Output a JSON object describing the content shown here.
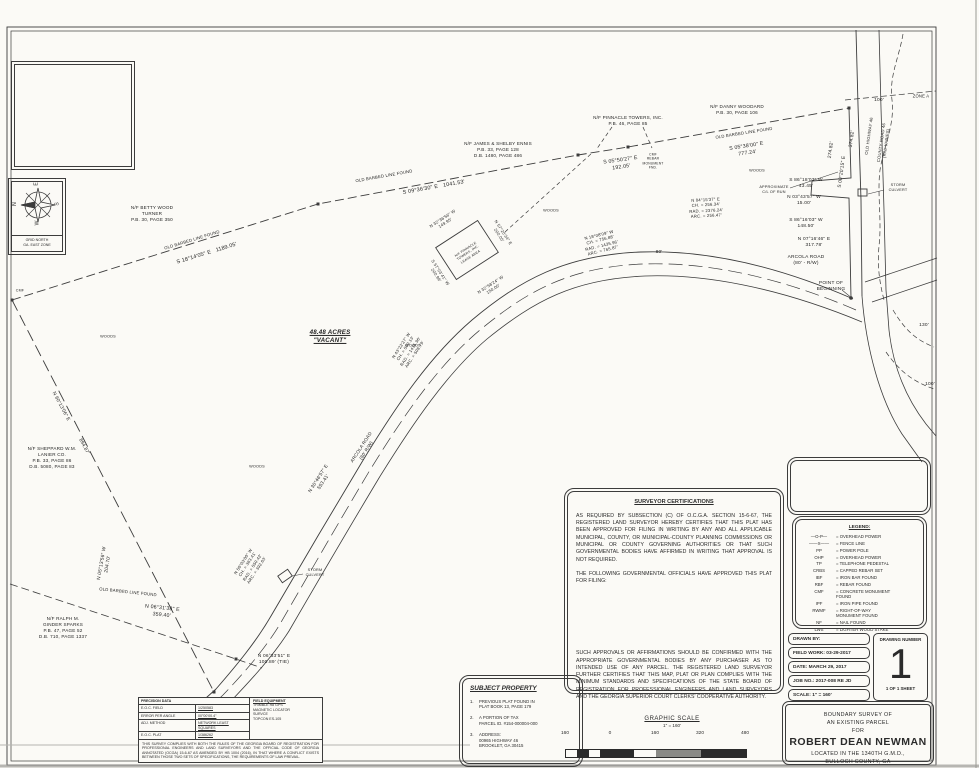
{
  "compass": {
    "n": "N",
    "e": "E",
    "s": "S",
    "w": "W",
    "caption": "GRID NORTH\nGA. EAST ZONE"
  },
  "parcel": {
    "acreage_label": "48.48 ACRES\n\"VACANT\""
  },
  "certs": {
    "title": "SURVEYOR CERTIFICATIONS",
    "p1": "AS REQUIRED BY SUBSECTION (C) OF O.C.G.A. SECTION 15-6-67, THE REGISTERED LAND SURVEYOR HEREBY CERTIFIES THAT THIS PLAT HAS BEEN APPROVED FOR FILING IN WRITING BY ANY AND ALL APPLICABLE MUNICIPAL, COUNTY, OR MUNICIPAL-COUNTY PLANNING COMMISSIONS OR MUNICIPAL OR COUNTY GOVERNING AUTHORITIES OR THAT SUCH GOVERNMENTAL BODIES HAVE AFFIRMED IN WRITING THAT APPROVAL IS NOT REQUIRED.",
    "p2": "THE FOLLOWING GOVERNMENTAL OFFICIALS HAVE APPROVED THIS PLAT FOR FILING:",
    "p3": "SUCH APPROVALS OR AFFIRMATIONS SHOULD BE CONFIRMED WITH THE APPROPRIATE GOVERNMENTAL BODIES BY ANY PURCHASER AS TO INTENDED USE OF ANY PARCEL. THE REGISTERED LAND SURVEYOR FURTHER CERTIFIES THAT THIS MAP, PLAT OR PLAN COMPLIES WITH THE MINIMUM STANDARDS AND SPECIFICATIONS OF THE STATE BOARD OF REGISTRATION FOR PROFESSIONAL ENGINEERS AND LAND SURVEYORS AND THE GEORGIA SUPERIOR COURT CLERKS' COOPERATIVE AUTHORITY."
  },
  "legend": {
    "title": "LEGEND:",
    "rows": [
      {
        "s": "—O-P—",
        "l": "= OVERHEAD POWER"
      },
      {
        "s": "——X——",
        "l": "= FENCE LINE"
      },
      {
        "s": "PP",
        "l": "= POWER POLE"
      },
      {
        "s": "OHP",
        "l": "= OVERHEAD POWER"
      },
      {
        "s": "TP",
        "l": "= TELEPHONE PEDESTAL"
      },
      {
        "s": "CRBS",
        "l": "= CAPPED REBAR SET"
      },
      {
        "s": "IBF",
        "l": "= IRON BAR FOUND"
      },
      {
        "s": "RBF",
        "l": "= REBAR FOUND"
      },
      {
        "s": "CMF",
        "l": "= CONCRETE MONUMENT\nFOUND"
      },
      {
        "s": "IPF",
        "l": "= IRON PIPE FOUND"
      },
      {
        "s": "RWMF",
        "l": "= RIGHT-OF-WAY\nMONUMENT FOUND"
      },
      {
        "s": "NF",
        "l": "= NAIL FOUND"
      },
      {
        "s": "LWS",
        "l": "= LIGHTER WOOD STAKE"
      }
    ]
  },
  "title_block": {
    "drawn_by": "DRAWN BY:",
    "field_work": "FIELD WORK: 03-29-2017",
    "date": "DATE: MARCH 29, 2017",
    "job_no": "JOB NO.: 2017-008 RE JD",
    "scale": "SCALE: 1\" = 160'",
    "drawing_number_label": "DRAWING NUMBER",
    "drawing_number": "1",
    "sheet": "1 OF 1 SHEET",
    "survey_title_lines": [
      "BOUNDARY SURVEY OF",
      "AN EXISTING PARCEL",
      "FOR",
      "ROBERT DEAN NEWMAN",
      "LOCATED IN THE 1340TH G.M.D.,",
      "BULLOCH COUNTY, GA"
    ]
  },
  "subject": {
    "title": "SUBJECT PROPERTY",
    "items": [
      {
        "n": "1.",
        "t": "PREVIOUS PLAT FOUND IN\nPLAT BOOK 13, PAGE 179"
      },
      {
        "n": "2.",
        "t": "A PORTION OF TAX\nPARCEL ID. #154-000004-000"
      },
      {
        "n": "3.",
        "t": "ADDRESS:\n00965 HIGHWAY 46\nBROOKLET, GA 30415"
      }
    ]
  },
  "precision": {
    "title": "PRECISION DATA",
    "rows": [
      {
        "k": "E.O.C. FIELD",
        "v": "1/250583"
      },
      {
        "k": "ERROR PER ANGLE",
        "v": "00°00'00.4\""
      },
      {
        "k": "ADJ. METHOD",
        "v": "NETWORK LEAST SQUARES"
      },
      {
        "k": "E.O.C. PLAT",
        "v": "1/386262"
      }
    ],
    "equip_title": "FIELD EQUIPMENT",
    "equip": [
      "TRIMBLE R8 GPS",
      "MAGNETIC LOCATOR",
      "SURVCE",
      "TOPCON ES-105"
    ],
    "note": "THIS SURVEY COMPLIES WITH BOTH THE RULES OF THE GEORGIA BOARD OF REGISTRATION FOR PROFESSIONAL ENGINEERS AND LAND SURVEYORS AND THE OFFICIAL CODE OF GEORGIA ANNOTATED (OCGA) 15-6-67 AS AMENDED BY HB 1004 (2016), IN THAT WHERE A CONFLICT EXISTS BETWEEN THOSE TWO SETS OF SPECIFICATIONS, THE REQUIREMENTS OF LAW PREVAIL."
  },
  "scale_bar": {
    "title": "GRAPHIC SCALE",
    "sub": "1\" = 160'",
    "ticks": [
      "160",
      "0",
      "160",
      "320",
      "480"
    ]
  },
  "map_labels": [
    {
      "t": "N/F BETTY WOOD\nTURNER\nP.B. 30, PAGE 350",
      "x": 152,
      "y": 214,
      "s": 4.6
    },
    {
      "t": "N/F JAMES & SHELBY ENNIS\nP.B. 33, PAGE 128\nD.B. 1480, PAGE 486",
      "x": 498,
      "y": 150,
      "s": 4.6
    },
    {
      "t": "N/F PINNACLE TOWERS, INC.\nP.B. 46, PAGE 85",
      "x": 628,
      "y": 121,
      "s": 4.6
    },
    {
      "t": "N/F DANNY WOODARD\nP.B. 30, PAGE 106",
      "x": 737,
      "y": 110,
      "s": 4.6
    },
    {
      "t": "N/F SHEPPARD W.M.\nLANIER CO.\nP.B. 33, PAGE 86\nD.B. 5080, PAGE 83",
      "x": 52,
      "y": 458,
      "s": 4.6
    },
    {
      "t": "N/F RALPH M.\nGINDER SPARKS\nP.B. 47, PAGE 52\nD.B. 710, PAGE 1337",
      "x": 63,
      "y": 628,
      "s": 4.6
    },
    {
      "t": "OLD BARBED LINE FOUND",
      "x": 192,
      "y": 240,
      "r": -17,
      "s": 4.2
    },
    {
      "t": "S 18°14'05\" E   1189.05'",
      "x": 207,
      "y": 254,
      "r": -17,
      "s": 5.4
    },
    {
      "t": "OLD BARBED LINE FOUND",
      "x": 384,
      "y": 176,
      "r": -10,
      "s": 4.2
    },
    {
      "t": "S 09°36'30\" E   1041.53'",
      "x": 434,
      "y": 188,
      "r": -10,
      "s": 5.4
    },
    {
      "t": "S 05°50'27\" E\n192.05'",
      "x": 621,
      "y": 164,
      "r": -8,
      "s": 5.2
    },
    {
      "t": "OLD BARBED LINE FOUND",
      "x": 744,
      "y": 133,
      "r": -9,
      "s": 4.2
    },
    {
      "t": "S 05°38'00\" E\n777.24'",
      "x": 747,
      "y": 150,
      "r": -9,
      "s": 5.2
    },
    {
      "t": "CMF\nREBAR\nMONUMENT\nFND.",
      "x": 653,
      "y": 161,
      "s": 3.3
    },
    {
      "t": "ZONE A",
      "x": 921,
      "y": 96,
      "s": 4.2
    },
    {
      "t": "100'",
      "x": 879,
      "y": 101,
      "s": 4.8
    },
    {
      "t": "S 00°20'15\" E",
      "x": 843,
      "y": 172,
      "r": -82,
      "s": 4.8
    },
    {
      "t": "374.82'",
      "x": 853,
      "y": 139,
      "r": -82,
      "s": 4.8
    },
    {
      "t": "274.82'",
      "x": 832,
      "y": 150,
      "r": -82,
      "s": 4.8
    },
    {
      "t": "OLD HIGHWAY 46",
      "x": 869,
      "y": 136,
      "r": -82,
      "s": 4.2
    },
    {
      "t": "COUNTY ROAD 46\n(R/W VARIES)",
      "x": 884,
      "y": 143,
      "r": -82,
      "s": 4.2
    },
    {
      "t": "STORM\nCULVERT",
      "x": 898,
      "y": 188,
      "s": 3.8
    },
    {
      "t": "APPROXIMATE\nC/L OF RUN",
      "x": 774,
      "y": 190,
      "s": 3.8
    },
    {
      "t": "S 86°18'03\" W\n43.45'",
      "x": 806,
      "y": 184,
      "s": 4.8
    },
    {
      "t": "N 03°43'57\" W\n15.00'",
      "x": 804,
      "y": 201,
      "s": 4.8
    },
    {
      "t": "S 86°16'03\" W\n148.50'",
      "x": 806,
      "y": 224,
      "s": 4.8
    },
    {
      "t": "N 07°16'46\" E\n317.78'",
      "x": 814,
      "y": 243,
      "s": 4.8
    },
    {
      "t": "ARCOLA ROAD\n(80' - R/W)",
      "x": 806,
      "y": 261,
      "s": 4.8
    },
    {
      "t": "POINT OF\nBEGINNING",
      "x": 831,
      "y": 287,
      "s": 4.8
    },
    {
      "t": "130'",
      "x": 924,
      "y": 326,
      "s": 4.8
    },
    {
      "t": "100'",
      "x": 930,
      "y": 385,
      "s": 4.8
    },
    {
      "t": "WOODS",
      "x": 551,
      "y": 211,
      "s": 3.8
    },
    {
      "t": "WOODS",
      "x": 757,
      "y": 171,
      "s": 3.8
    },
    {
      "t": "WOODS",
      "x": 413,
      "y": 346,
      "s": 3.8
    },
    {
      "t": "WOODS",
      "x": 108,
      "y": 337,
      "s": 3.8
    },
    {
      "t": "WOODS",
      "x": 257,
      "y": 467,
      "s": 3.8
    },
    {
      "t": "48.48 ACRES\n\"VACANT\"",
      "x": 330,
      "y": 337,
      "s": 6.2,
      "cls": "acres"
    },
    {
      "t": "N 32°36'56\" W\n149.95'",
      "x": 444,
      "y": 221,
      "r": -33,
      "s": 4.2
    },
    {
      "t": "N 57°20'34\" E\n200.05'",
      "x": 501,
      "y": 234,
      "r": 57,
      "s": 4.2
    },
    {
      "t": "S 57°03'41\" W\n200.96'",
      "x": 438,
      "y": 274,
      "r": 57,
      "s": 4.2
    },
    {
      "t": "N 32°58'24\" W\n150.00'",
      "x": 492,
      "y": 287,
      "r": -33,
      "s": 4.2
    },
    {
      "t": "N/F PINNACLE\nTOWERS, INC.\nLEASE AREA",
      "x": 468,
      "y": 253,
      "r": -33,
      "s": 3.3
    },
    {
      "t": "N 43°22'27\" W\nCH. = 500.13'\nRAD. = 1435.96'\nARC. = 508.79'",
      "x": 408,
      "y": 350,
      "r": -57,
      "s": 4.2
    },
    {
      "t": "N 18°08'09\" W\nCH. = 756.88'\nRAD. = 1435.96'\nARC. = 765.87'",
      "x": 601,
      "y": 243,
      "r": -14,
      "s": 4.2
    },
    {
      "t": "N 04°15'37\" E\nCH. = 256.34'\nRAD. = 2376.24'\nARC. = 256.47'",
      "x": 706,
      "y": 208,
      "r": -3,
      "s": 4.2
    },
    {
      "t": "N 50°03'00\" W\nCH. = 383.41'\nRAD. = 550.42'\nARC. = 392.63'",
      "x": 250,
      "y": 566,
      "r": -57,
      "s": 4.2
    },
    {
      "t": "80'",
      "x": 659,
      "y": 253,
      "s": 4.8
    },
    {
      "t": "ARCOLA ROAD\n(80' R/W)",
      "x": 364,
      "y": 449,
      "r": -57,
      "s": 4.6
    },
    {
      "t": "N 30°46'57\" E\n553.41'",
      "x": 322,
      "y": 481,
      "r": -57,
      "s": 4.8
    },
    {
      "t": "N 05°13'56\" W\n204.70'",
      "x": 106,
      "y": 564,
      "r": -80,
      "s": 4.8
    },
    {
      "t": "N 60°13'06\" E",
      "x": 60,
      "y": 407,
      "r": 62,
      "s": 4.8
    },
    {
      "t": "894.87'",
      "x": 83,
      "y": 447,
      "r": 62,
      "s": 4.8
    },
    {
      "t": "OLD BARBED LINE FOUND",
      "x": 128,
      "y": 592,
      "r": 6,
      "s": 4.2
    },
    {
      "t": "N 06°31'38\" E\n359.40'",
      "x": 162,
      "y": 612,
      "r": 6,
      "s": 5.2
    },
    {
      "t": "N 06°33'51\" E\n100.89' (TIE)",
      "x": 274,
      "y": 660,
      "s": 4.8
    },
    {
      "t": "STORM\nCULVERT",
      "x": 315,
      "y": 573,
      "s": 3.8
    },
    {
      "t": "CMF",
      "x": 20,
      "y": 291,
      "s": 3.6
    }
  ]
}
